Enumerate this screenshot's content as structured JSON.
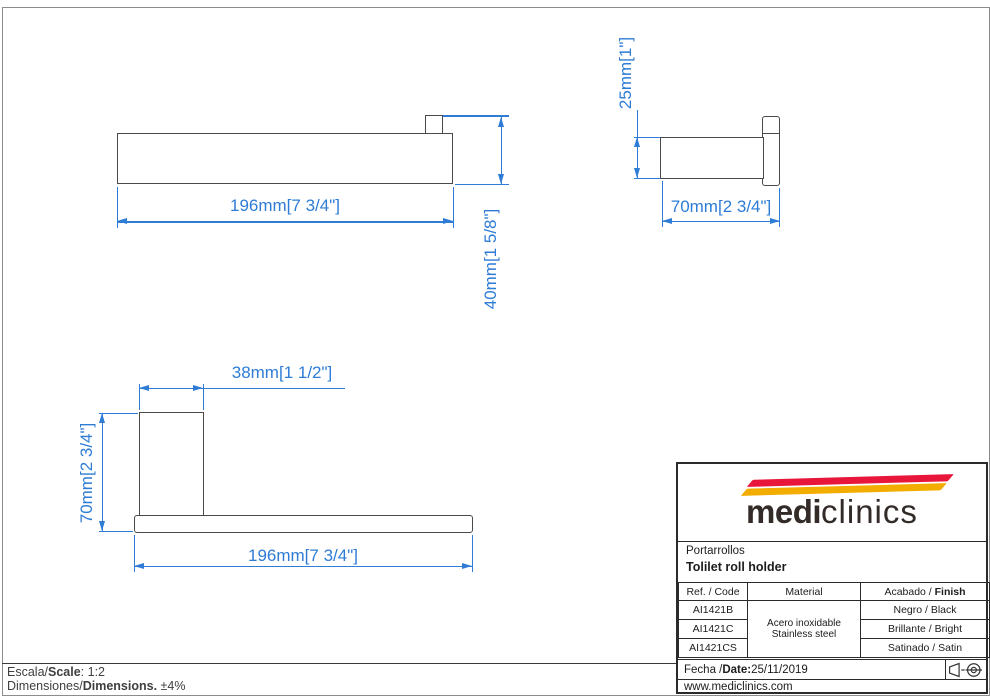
{
  "dimensions": {
    "front_length": "196mm[7 3/4\"]",
    "front_height": "40mm[1 5/8\"]",
    "side_height": "25mm[1\"]",
    "side_depth": "70mm[2 3/4\"]",
    "top_width": "38mm[1 1/2\"]",
    "top_depth": "70mm[2 3/4\"]",
    "top_length": "196mm[7 3/4\"]"
  },
  "title_block": {
    "logo": {
      "word_bold": "medi",
      "word_light": "clinics",
      "swoosh_red": "#e8163a",
      "swoosh_yellow": "#f2ad00"
    },
    "product_name_es": "Portarrollos",
    "product_name_en": "Tolilet roll holder",
    "table": {
      "header_ref": "Ref. / Code",
      "header_material": "Material",
      "header_finish_prefix": "Acabado / ",
      "header_finish_bold": "Finish",
      "material_line1": "Acero inoxidable",
      "material_line2": "Stainless steel",
      "rows": [
        {
          "code": "AI1421B",
          "finish": "Negro / Black"
        },
        {
          "code": "AI1421C",
          "finish": "Brillante / Bright"
        },
        {
          "code": "AI1421CS",
          "finish": "Satinado / Satin"
        }
      ]
    },
    "date_prefix": "Fecha / ",
    "date_bold": "Date:",
    "date_value": " 25/11/2019",
    "website": "www.mediclinics.com"
  },
  "footer": {
    "scale_prefix": "Escala/",
    "scale_bold": "Scale",
    "scale_suffix": ":  1:2",
    "dims_prefix": "Dimensiones/",
    "dims_bold": "Dimensions.",
    "dims_suffix": " ±4%"
  },
  "colors": {
    "dimension_blue": "#2e7cd6",
    "drawing_line": "#4a4a4a"
  }
}
